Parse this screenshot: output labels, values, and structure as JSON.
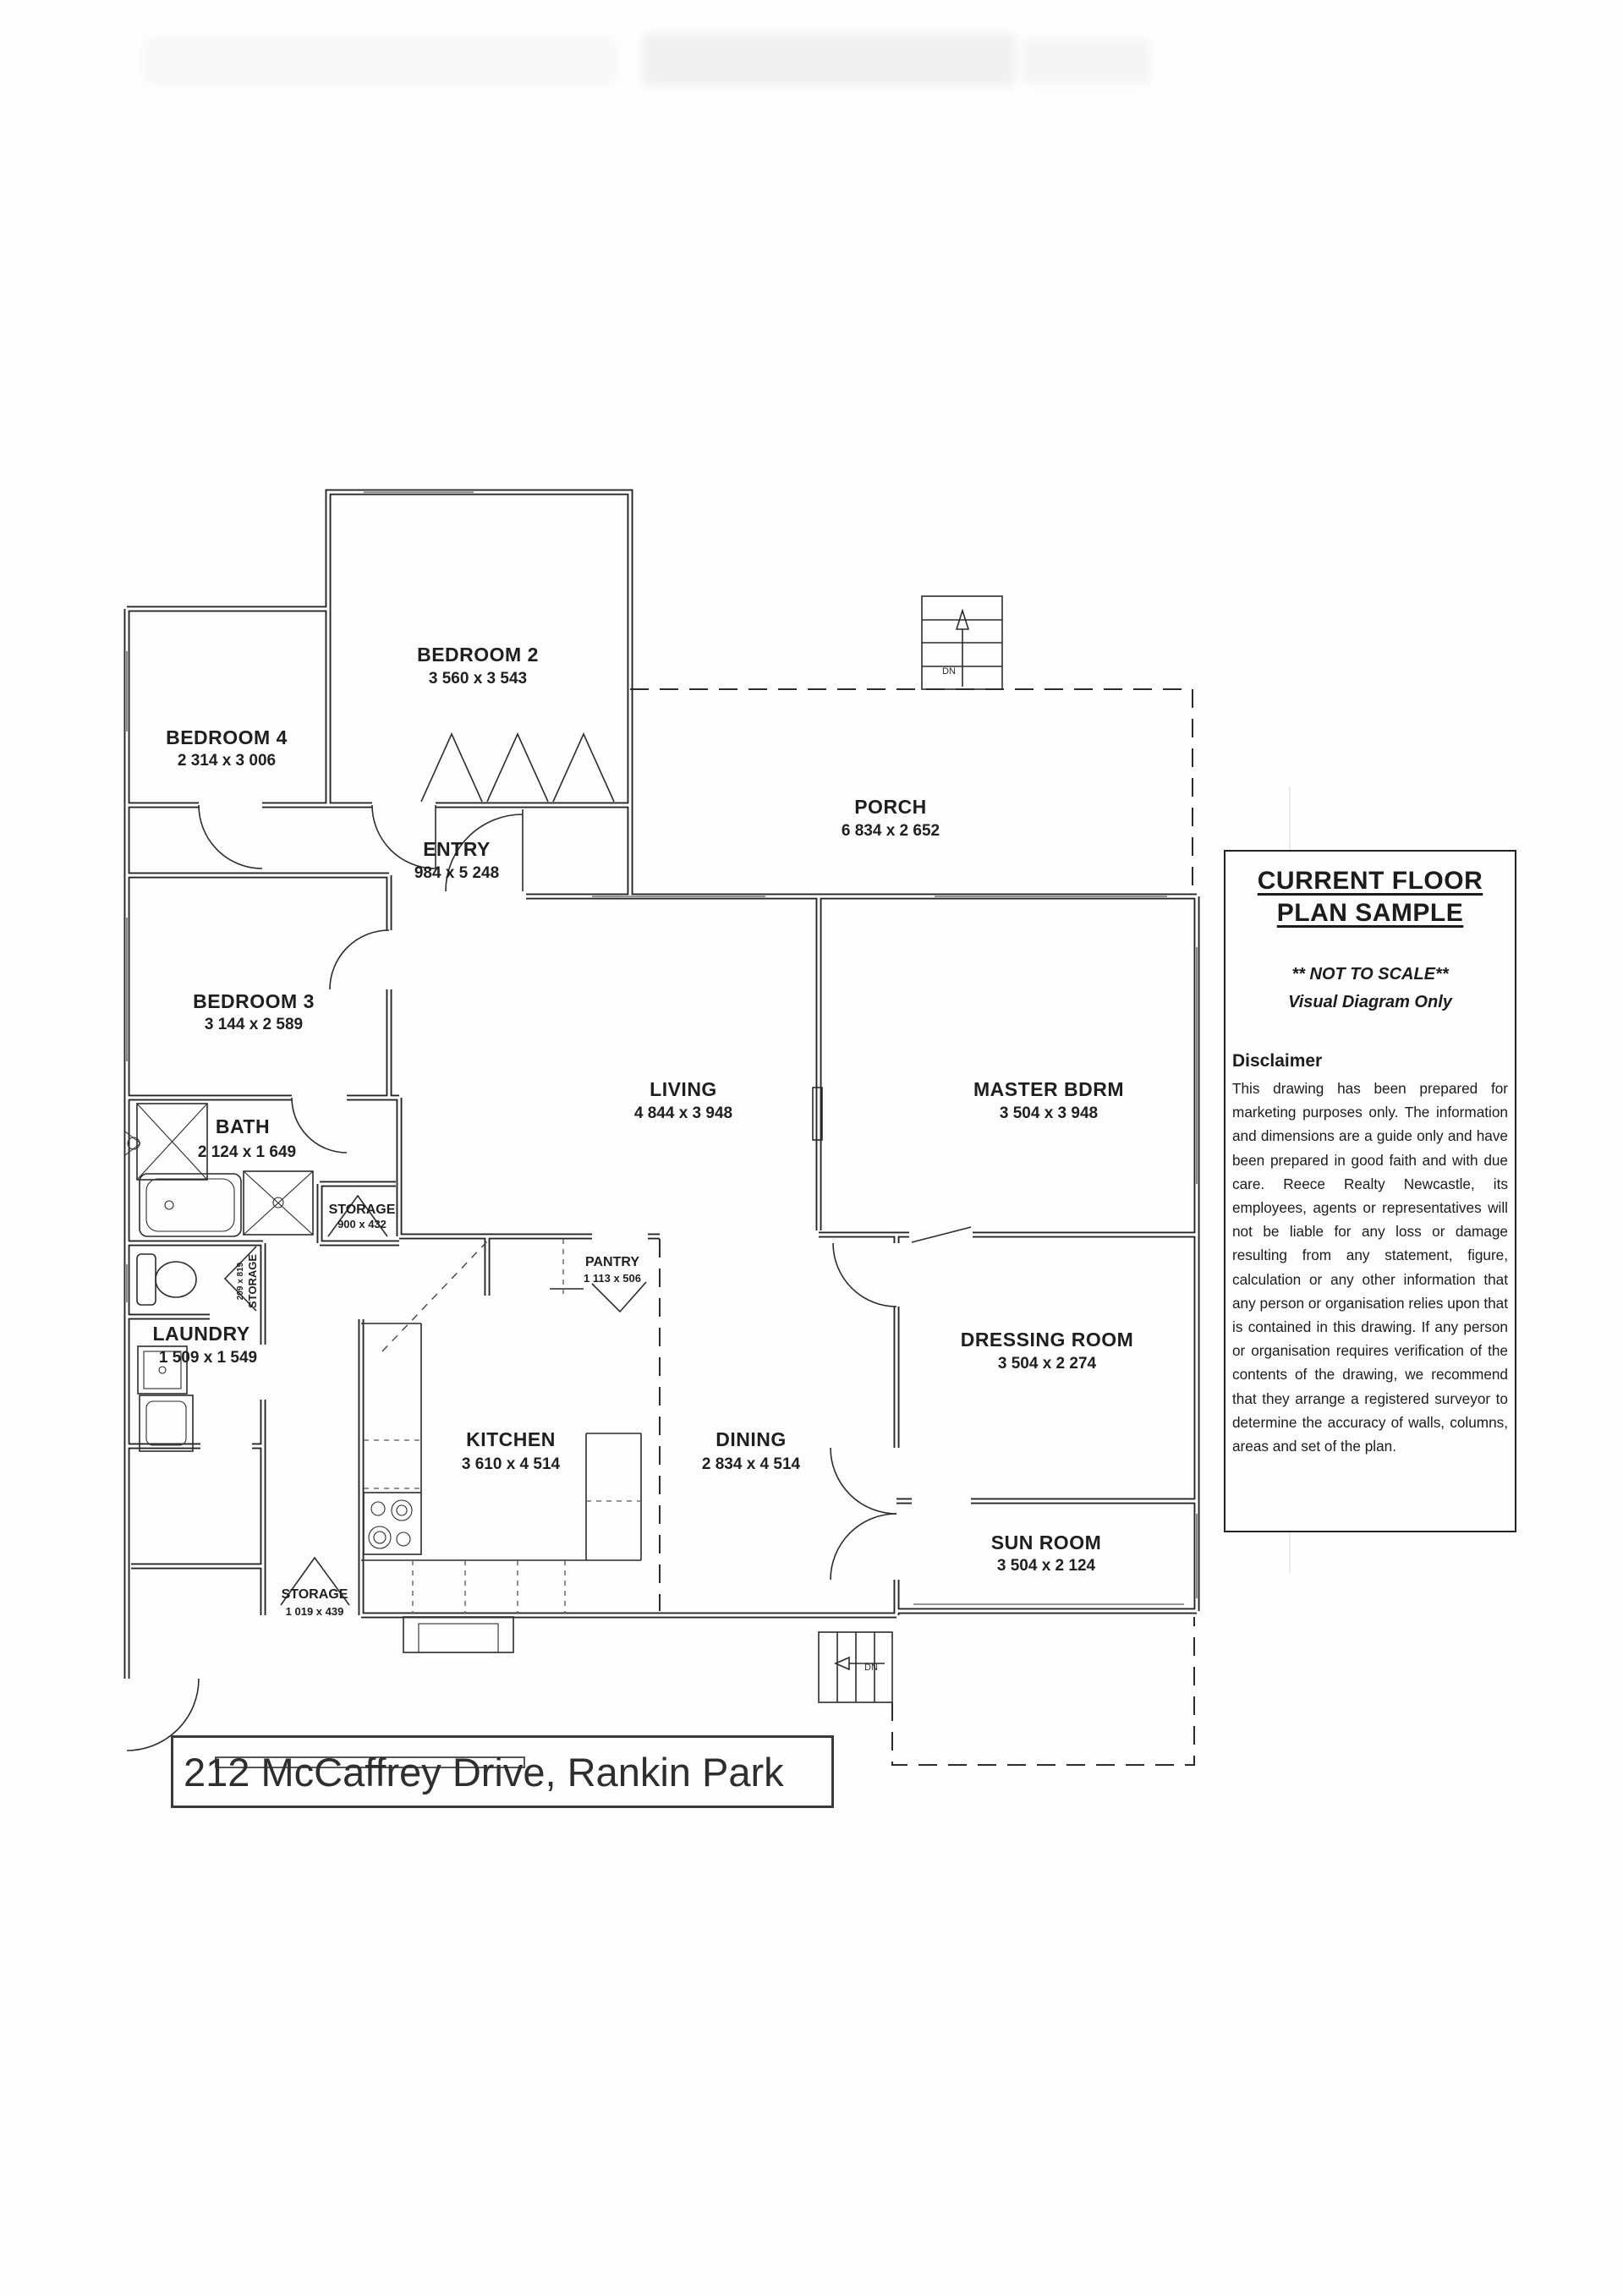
{
  "colors": {
    "paper": "#fefefe",
    "ink": "#262626"
  },
  "floor_plan": {
    "rooms": {
      "bedroom2": {
        "label": "BEDROOM 2",
        "dims": "3 560 x 3 543"
      },
      "bedroom4": {
        "label": "BEDROOM 4",
        "dims": "2 314 x 3 006"
      },
      "entry": {
        "label": "ENTRY",
        "dims": "984 x 5 248"
      },
      "porch": {
        "label": "PORCH",
        "dims": "6 834 x 2 652"
      },
      "bedroom3": {
        "label": "BEDROOM 3",
        "dims": "3 144 x 2 589"
      },
      "living": {
        "label": "LIVING",
        "dims": "4 844 x 3 948"
      },
      "master": {
        "label": "MASTER BDRM",
        "dims": "3 504 x 3 948"
      },
      "bath": {
        "label": "BATH",
        "dims": "2 124 x 1 649"
      },
      "storage_bath": {
        "label": "STORAGE",
        "dims": "900 x 432"
      },
      "storage_hall": {
        "label": "STORAGE",
        "dims": "209 x 819"
      },
      "laundry": {
        "label": "LAUNDRY",
        "dims": "1 509 x 1 549"
      },
      "pantry": {
        "label": "PANTRY",
        "dims": "1 113 x 506"
      },
      "kitchen": {
        "label": "KITCHEN",
        "dims": "3 610 x 4 514"
      },
      "dining": {
        "label": "DINING",
        "dims": "2 834 x 4 514"
      },
      "dressing": {
        "label": "DRESSING ROOM",
        "dims": "3 504 x 2 274"
      },
      "sunroom": {
        "label": "SUN ROOM",
        "dims": "3 504 x 2 124"
      },
      "storage_rear": {
        "label": "STORAGE",
        "dims": "1 019 x 439"
      }
    },
    "stairs": {
      "top_label": "DN",
      "bottom_label": "DN"
    },
    "address": "212 McCaffrey Drive, Rankin Park"
  },
  "side_panel": {
    "title_line1": "CURRENT FLOOR",
    "title_line2": "PLAN SAMPLE",
    "not_to_scale": "** NOT TO SCALE**",
    "visual_diagram": "Visual Diagram Only",
    "disclaimer_heading": "Disclaimer",
    "disclaimer_text": "This drawing has been prepared for marketing purposes only. The information and dimensions are a guide only and have been prepared in good faith and with due care. Reece Realty Newcastle, its employees, agents or representatives will not be liable for any loss or damage resulting from any statement, figure, calculation or any other information that any person or organisation relies upon that is contained in this drawing. If any person or organisation requires verification of the contents of the drawing, we recommend that they arrange a registered surveyor to determine the accuracy of walls, columns, areas and set of the plan."
  }
}
